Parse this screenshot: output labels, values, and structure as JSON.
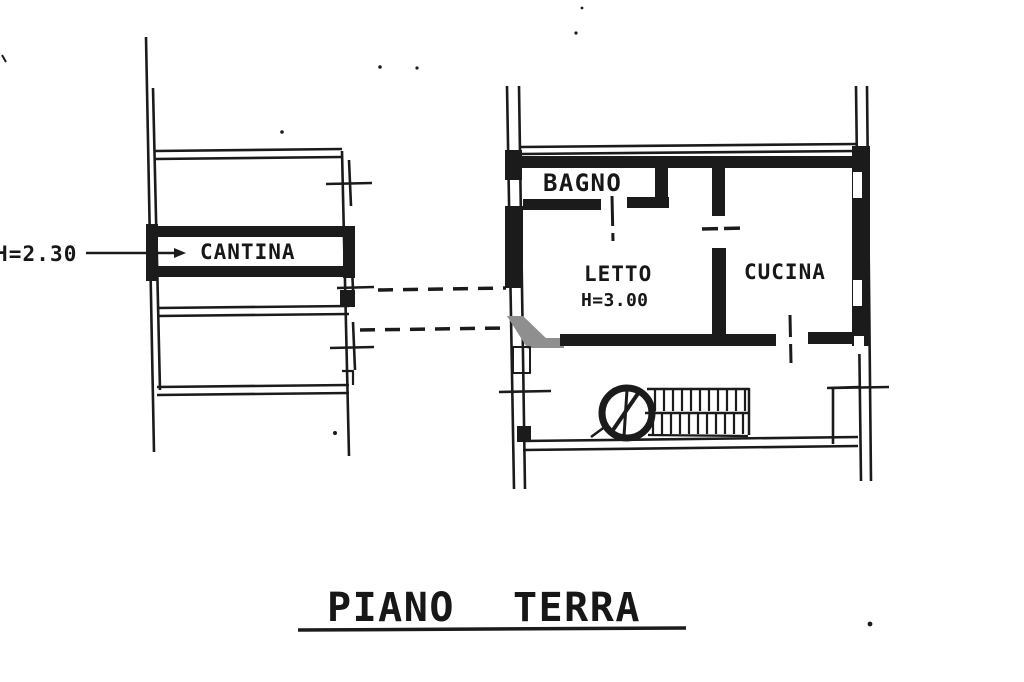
{
  "title": {
    "word1": "PIANO",
    "word2": "TERRA"
  },
  "rooms": {
    "cantina": {
      "label": "CANTINA",
      "height_note": "H=2.30"
    },
    "bagno": {
      "label": "BAGNO"
    },
    "letto": {
      "label": "LETTO",
      "height_note": "H=3.00"
    },
    "cucina": {
      "label": "CUCINA"
    }
  },
  "colors": {
    "ink": "#1b1b1b",
    "paper": "#ffffff",
    "gray_wall": "#8f8f8f"
  }
}
